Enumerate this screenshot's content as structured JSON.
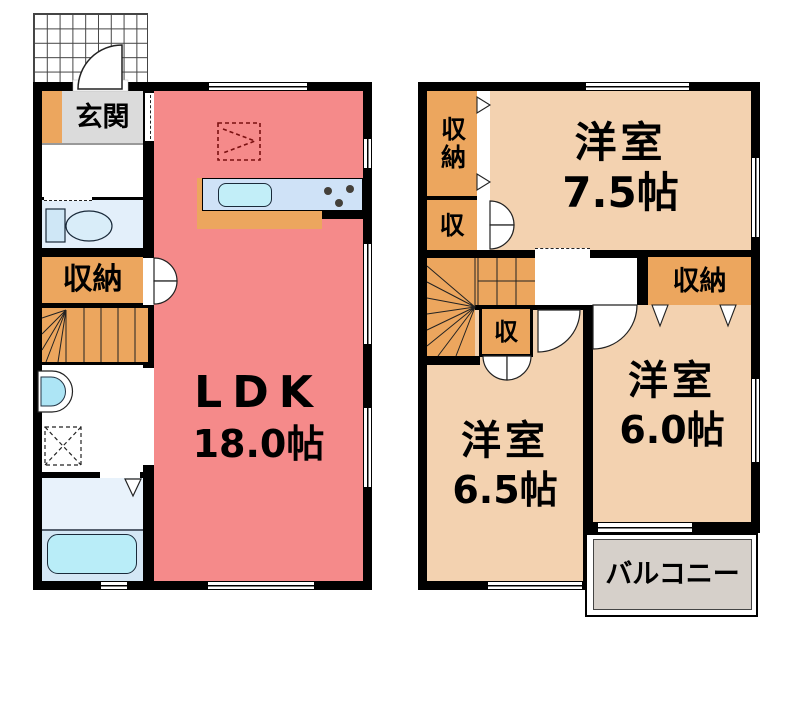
{
  "palette": {
    "wall": "#000000",
    "ldk": "#f58a8a",
    "wood": "#eca65e",
    "room": "#f3d2b0",
    "genkan": "#dbdbdb",
    "balcony": "#d6d0ca",
    "toilet": "#e3effa",
    "bath": "#d4e7f5",
    "bathlight": "#e8f2fb",
    "fixture": "#b9edf8",
    "counter": "#cfe2f7",
    "sink": "#c2eef8",
    "basin": "#ade5f5"
  },
  "floor1": {
    "entrance_label": "玄関",
    "closet_label": "収納",
    "ldk_label": "LDK",
    "ldk_size": "18.0帖"
  },
  "floor2": {
    "closet_tall_label": "収納",
    "closet_left_label": "収",
    "closet_mid_label": "収",
    "closet_right_label": "収納",
    "room75_label": "洋室",
    "room75_size": "7.5帖",
    "room65_label": "洋室",
    "room65_size": "6.5帖",
    "room60_label": "洋室",
    "room60_size": "6.0帖",
    "balcony_label": "バルコニー"
  }
}
